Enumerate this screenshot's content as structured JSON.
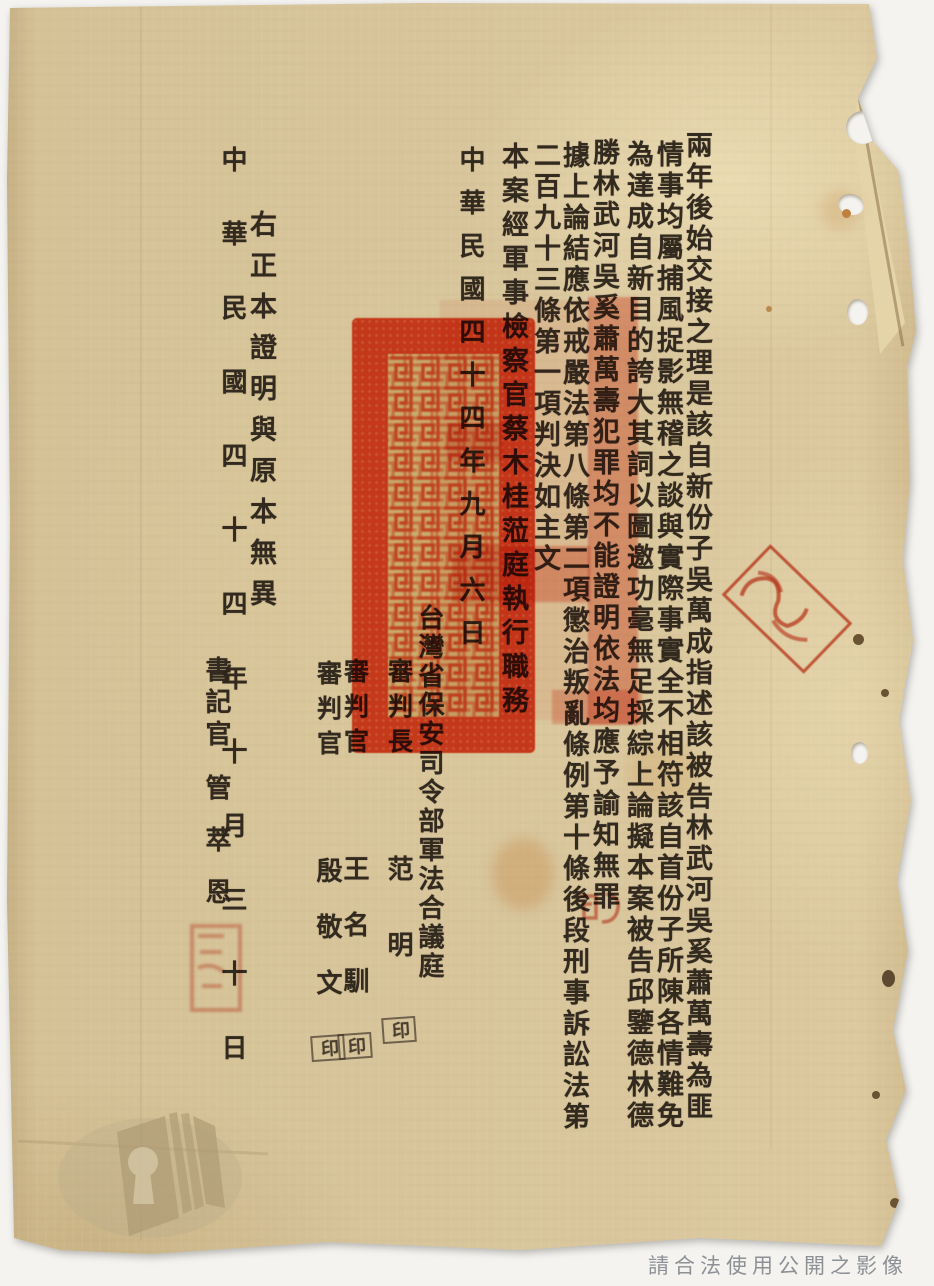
{
  "doc": {
    "body_columns": [
      "兩年後始交接之理是該自新份子吳萬成指述該被告林武河吳奚蕭萬壽為匪",
      "情事均屬捕風捉影無稽之談與實際事實全不相符該自首份子所陳各情難免",
      "為達成自新目的誇大其詞以圖邀功毫無足採綜上論擬本案被告邱鑒德林德",
      "勝林武河吳奚蕭萬壽犯罪均不能證明依法均應予諭知無罪",
      "據上論結應依戒嚴法第八條第二項懲治叛亂條例第十條後段刑事訴訟法第",
      "二百九十三條第一項判決如主文",
      "本案經軍事檢察官蔡木桂蒞庭執行職務",
      "中華民國四十四年九月六日"
    ],
    "court_line": "台灣省保安司令部軍法合議庭",
    "signatures": [
      {
        "title": "審判長",
        "name": "范明",
        "seal_mark": "印"
      },
      {
        "title": "審判官",
        "name": "王名馴",
        "seal_mark": "印"
      },
      {
        "title": "審判官",
        "name": "殷敬文",
        "seal_mark": "印"
      }
    ],
    "certification": "右正本證明與原本無異",
    "cert_date": "中華民國四十四年十月三十日",
    "clerk_title": "書記官",
    "clerk_name": "管萃恩"
  },
  "stamps": {
    "large_official_seal_color": "#e8482a",
    "edge_seal_color": "#cd371c",
    "small_seal_color": "#d05038"
  },
  "watermark": {
    "text": "請合法使用公開之影像",
    "color": "#8d9195"
  },
  "paper": {
    "base_color": "#d8c59c",
    "background_color": "#f4f3f0",
    "ink_color": "#2c231a"
  }
}
